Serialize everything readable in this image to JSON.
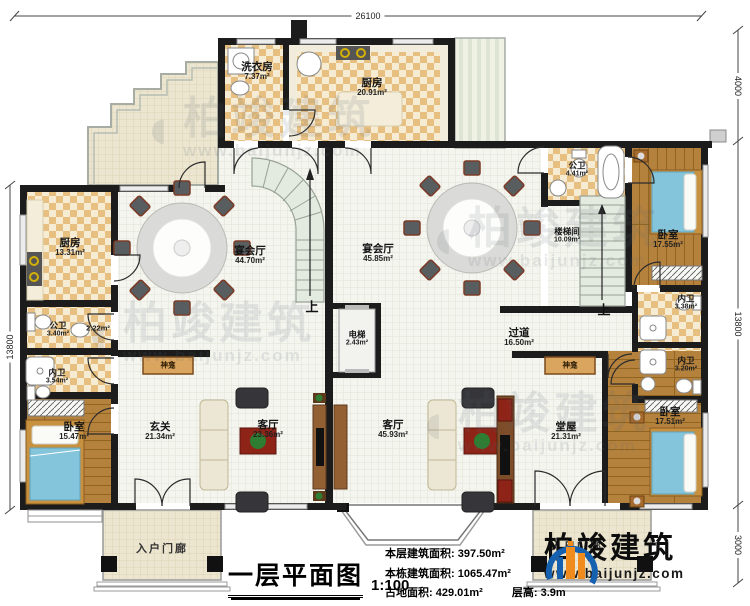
{
  "title_block": {
    "title": "一层平面图",
    "scale": "1:100"
  },
  "stats": {
    "floor_area_label": "本层建筑面积:",
    "floor_area_value": "397.50m²",
    "total_area_label": "本栋建筑面积:",
    "total_area_value": "1065.47m²",
    "land_area_label": "占地面积:",
    "land_area_value": "429.01m²",
    "height_label": "层高:",
    "height_value": "3.9m"
  },
  "brand": {
    "name": "柏竣建筑",
    "url": "www.baijunjz.com"
  },
  "watermark": {
    "name": "柏竣建筑",
    "url": "www.baijunjz.com"
  },
  "dimensions": {
    "top": "26100",
    "right_top": "4000",
    "right_middle": "13800",
    "right_bottom": "3000",
    "left": "13800"
  },
  "rooms": [
    {
      "name": "洗衣房",
      "area": "7.37m²"
    },
    {
      "name": "厨房",
      "area": "20.91m²"
    },
    {
      "name": "厨房",
      "area": "13.31m²"
    },
    {
      "name": "公卫",
      "area": "3.40m²"
    },
    {
      "name": "内卫",
      "area": "3.54m²"
    },
    {
      "name": "卧室",
      "area": "15.47m²"
    },
    {
      "name": "玄关",
      "area": "21.34m²"
    },
    {
      "name": "客厅",
      "area": "23.36m²"
    },
    {
      "name": "宴会厅",
      "area": "44.70m²"
    },
    {
      "name": "宴会厅",
      "area": "45.85m²"
    },
    {
      "name": "电梯",
      "area": "2.43m²"
    },
    {
      "name": "过道",
      "area": "16.50m²"
    },
    {
      "name": "公卫",
      "area": "4.41m²"
    },
    {
      "name": "楼梯间",
      "area": "10.09m²"
    },
    {
      "name": "卧室",
      "area": "17.55m²"
    },
    {
      "name": "内卫",
      "area": "3.38m²"
    },
    {
      "name": "内卫",
      "area": "3.20m²"
    },
    {
      "name": "卧室",
      "area": "17.51m²"
    },
    {
      "name": "堂屋",
      "area": "21.31m²"
    },
    {
      "name": "客厅",
      "area": "45.93m²"
    }
  ],
  "labels": {
    "up": "上",
    "shrine": "神龛",
    "porch": "入户门廊",
    "closet_area": "2.22m²"
  }
}
